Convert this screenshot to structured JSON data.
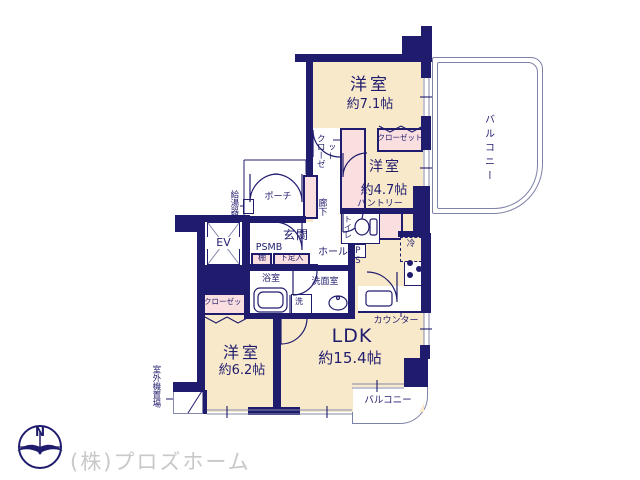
{
  "colors": {
    "wall": "#201c6d",
    "room_fill": "#f8e9cb",
    "closet_fill": "#fadfe0",
    "window_line": "#8489ad",
    "watermark": "#c8c8c8"
  },
  "compass": {
    "north": "N"
  },
  "watermark": "(株)プロズホーム",
  "rooms": {
    "western_71": {
      "name": "洋室",
      "size": "約7.1帖"
    },
    "western_47": {
      "name": "洋室",
      "size": "約4.7帖"
    },
    "western_62": {
      "name": "洋室",
      "size": "約6.2帖"
    },
    "ldk": {
      "name": "LDK",
      "size": "約15.4帖"
    }
  },
  "labels": {
    "balcony_right": "バルコニー",
    "balcony_bottom": "バルコニー",
    "closet_top": "クローゼット",
    "closet_mid": "クローゼット",
    "closet_62": "クローゼット",
    "pantry": "パントリー",
    "hallway": "廊下",
    "porch": "ポーチ",
    "water_heater": "給湯器",
    "entrance": "玄関",
    "shelf": "棚",
    "shoe_cabinet": "下足入",
    "psmb": "PSMB",
    "elevator": "EV",
    "toilet": "トイレ",
    "hall": "ホール",
    "pipe_space": "PS",
    "refrigerator": "冷",
    "bathroom": "浴室",
    "washroom": "洗面室",
    "laundry": "洗",
    "counter": "カウンター",
    "outdoor_unit": "室外機置場"
  }
}
